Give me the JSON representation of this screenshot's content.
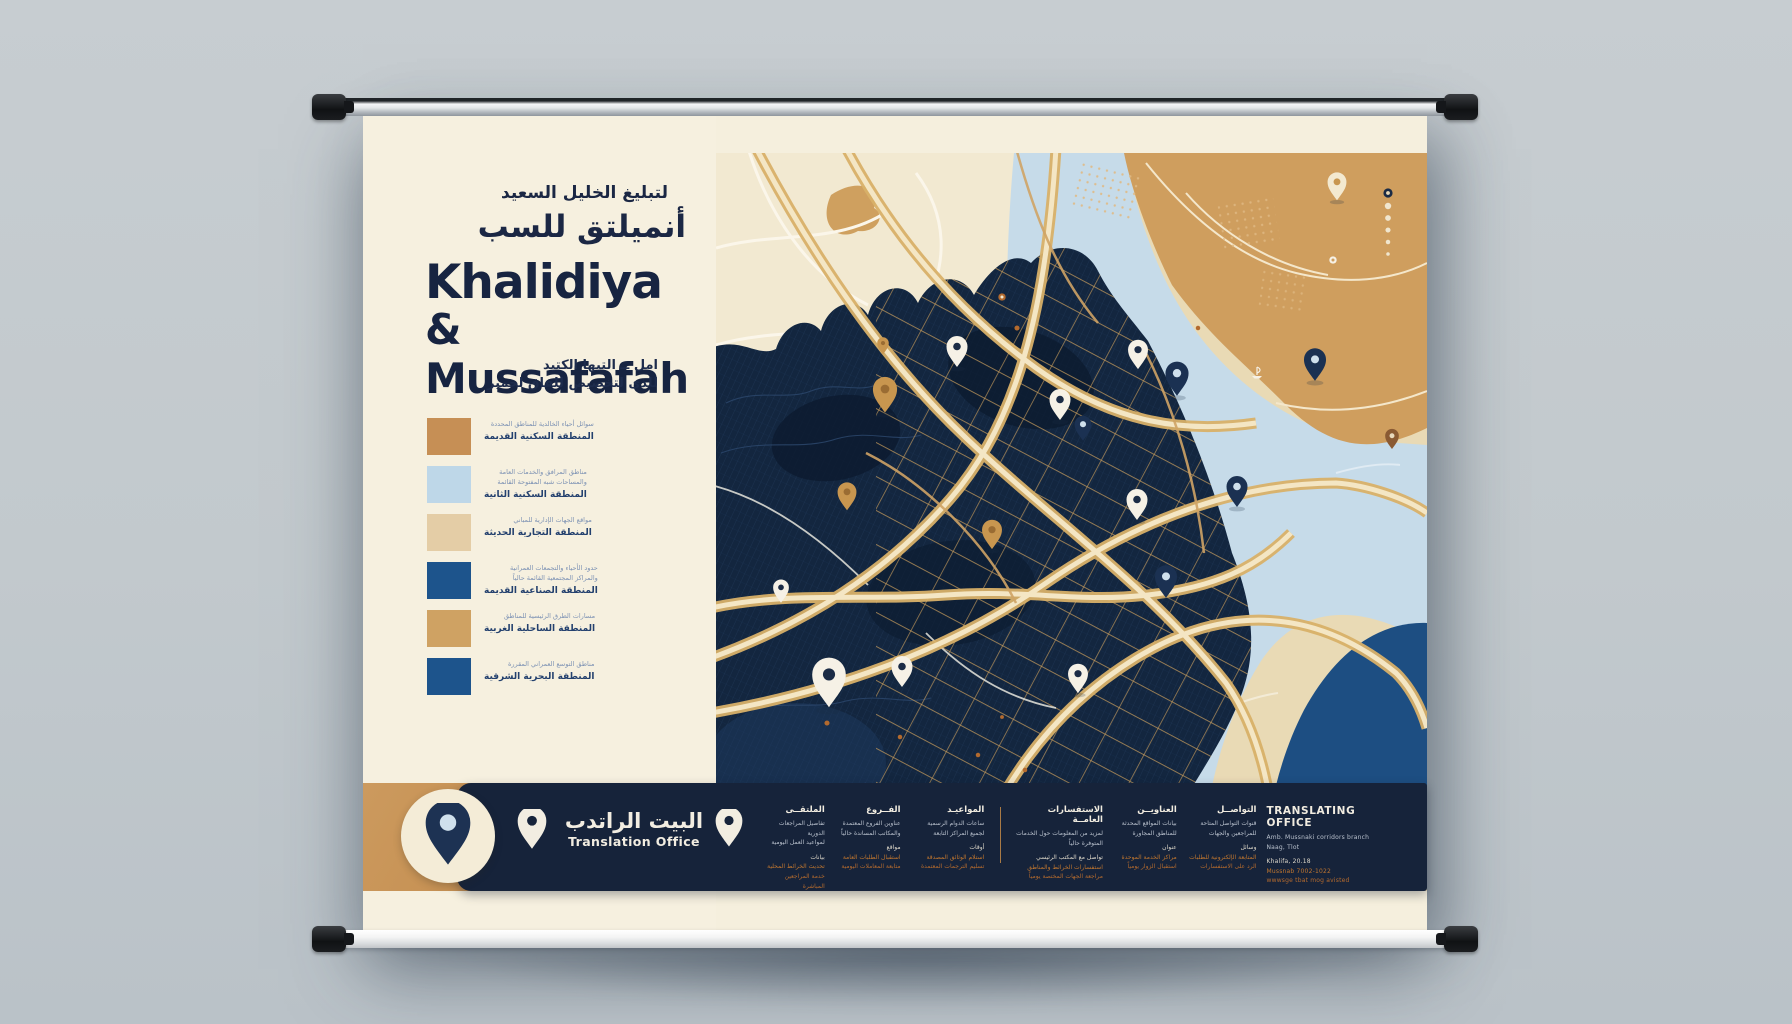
{
  "poster": {
    "title": {
      "ar_line1": "لتبليغ الخليل السعيد",
      "ar_line2": "أنميلتق للسب",
      "en_line1": "Khalidiya",
      "en_line2": "& Mussafafah",
      "sub_ar_line1": "امل ــ التيها الكتيد",
      "sub_ar_line2": "للذى لتخصيص للفاق لحمير"
    },
    "legend": {
      "items": [
        {
          "color": "#c68f55",
          "lines": [
            {
              "style": "small",
              "text": "سوائل أحياء الخالدية للمناطق المحددة"
            },
            {
              "style": "bold",
              "text": "المنطقة السكنية القديمة"
            }
          ]
        },
        {
          "color": "#bed7e8",
          "lines": [
            {
              "style": "small",
              "text": "مناطق المرافق والخدمات العامة"
            },
            {
              "style": "small",
              "text": "والمساحات شبه المفتوحة القائمة"
            },
            {
              "style": "bold",
              "text": "المنطقة السكنية الثانية"
            }
          ]
        },
        {
          "color": "#e4cda6",
          "lines": [
            {
              "style": "small",
              "text": "مواقع الجهات الإدارية للمباني"
            },
            {
              "style": "bold",
              "text": "المنطقة التجارية الحديثة"
            }
          ]
        },
        {
          "color": "#1d548c",
          "lines": [
            {
              "style": "small",
              "text": "حدود الأحياء والتجمعات العمرانية"
            },
            {
              "style": "small",
              "text": "والمراكز المجتمعية القائمة حالياً"
            },
            {
              "style": "bold",
              "text": "المنطقة الصناعية القديمة"
            }
          ]
        },
        {
          "color": "#cfa263",
          "lines": [
            {
              "style": "small",
              "text": "مسارات الطرق الرئيسية للمناطق"
            },
            {
              "style": "bold",
              "text": "المنطقة الساحلية الغربية"
            }
          ]
        },
        {
          "color": "#1d548c",
          "lines": [
            {
              "style": "small",
              "text": "مناطق التوسع العمراني المقررة"
            },
            {
              "style": "bold",
              "text": "المنطقة البحرية الشرقية"
            }
          ]
        }
      ]
    },
    "footer": {
      "brand": {
        "ar": "البيت الراتدب",
        "en": "Translation Office"
      },
      "columns": [
        {
          "header": "الملتقــى",
          "width": 62,
          "lines": [
            "تفاصيل المراجعات الدورية",
            "لمواعيد العمل اليومية",
            "بيانات",
            "تحديث الخرائط المحلية",
            "خدمة المراجعين المباشرة"
          ]
        },
        {
          "header": "الفــروع",
          "width": 66,
          "lines": [
            "عناوين الفروع المعتمدة",
            "والمكاتب المساندة حالياً",
            "مواقع",
            "استقبال الطلبات العامة",
            "متابعة المعاملات اليومية"
          ]
        },
        {
          "header": "المواعيـد",
          "width": 74,
          "lines": [
            "ساعات الدوام الرسمية",
            "لجميع المراكز التابعة",
            "أوقات",
            "استلام الوثائق المصدقة",
            "تسليم الترجمات المعتمدة"
          ]
        },
        {
          "header": "الاستفسارات العامــة",
          "width": 88,
          "divider_before": true,
          "lines": [
            "لمزيد من المعلومات حول الخدمات",
            "المتوفرة حالياً",
            "تواصل مع المكتب الرئيسي",
            "استفسارات الخرائط والمناطق",
            "مراجعة الجهات المختصة يومياً"
          ]
        },
        {
          "header": "العناويــن",
          "width": 64,
          "lines": [
            "بيانات المواقع المحدثة",
            "للمناطق المجاورة",
            "عنوان",
            "مراكز الخدمة الموحدة",
            "استقبال الزوار يومياً"
          ]
        },
        {
          "header": "التواصــل",
          "width": 70,
          "lines": [
            "قنوات التواصل المتاحة",
            "للمراجعين والجهات",
            "وسائل",
            "المتابعة الإلكترونية للطلبات",
            "الرد على الاستفسارات"
          ]
        },
        {
          "header": "TRANSLATING OFFICE",
          "width": 135,
          "latin": true,
          "lines": [
            "Amb. Mussnaki corridors branch",
            "Naag, Tlot",
            "Khalifa, 20.18",
            "Mussnab 7002-1022",
            "wwwsge tbat mog avisted"
          ]
        }
      ]
    },
    "map": {
      "colors": {
        "base": "#e9dab5",
        "light": "#f2e9d1",
        "tan_land": "#cf9e5e",
        "river": "#c6dbe9",
        "deep_water": "#1d4e82",
        "city": "#13263f",
        "city_dark": "#0d1b30",
        "road_gold": "#e6c48c",
        "road_core": "#f7ecd2",
        "white_road": "#faf4e6",
        "accent_orange": "#b36a2e"
      },
      "pin_colors": {
        "white": {
          "body": "#f6f1e6",
          "hole": "#1b2b45"
        },
        "navy": {
          "body": "#1b3152",
          "hole": "#cfe0ec"
        },
        "gold": {
          "body": "#c8964f",
          "hole": "#9a6c33"
        },
        "cream": {
          "body": "#f3e9d0",
          "hole": "#c8964f"
        },
        "brown": {
          "body": "#8a5a33",
          "hole": "#e8d9bd"
        },
        "dot-orange": {
          "body": "#b36a2e"
        },
        "dot-cream": {
          "body": "#f0e6cf"
        },
        "dot-white": {
          "body": "#f6f1e6"
        },
        "ring-navy": {
          "body": "#1b2b45",
          "hole": "#ead9b5"
        },
        "ring-white": {
          "body": "#f6f1e6",
          "hole": "#cf9e5e"
        },
        "ring-orange": {
          "body": "#b36a2e",
          "hole": "#f3e9d0"
        }
      },
      "pins": [
        {
          "x": 621,
          "y": 32,
          "kind": "cream",
          "s": 0.9
        },
        {
          "x": 672,
          "y": 40,
          "kind": "ring-navy",
          "s": 1
        },
        {
          "x": 672,
          "y": 53,
          "kind": "dot-cream",
          "s": 1
        },
        {
          "x": 672,
          "y": 65,
          "kind": "dot-cream",
          "s": 0.9
        },
        {
          "x": 672,
          "y": 77,
          "kind": "dot-cream",
          "s": 0.8
        },
        {
          "x": 672,
          "y": 89,
          "kind": "dot-cream",
          "s": 0.7
        },
        {
          "x": 672,
          "y": 101,
          "kind": "dot-cream",
          "s": 0.55
        },
        {
          "x": 617,
          "y": 107,
          "kind": "ring-white",
          "s": 0.8
        },
        {
          "x": 286,
          "y": 144,
          "kind": "ring-orange",
          "s": 0.8
        },
        {
          "x": 301,
          "y": 175,
          "kind": "dot-orange",
          "s": 0.8
        },
        {
          "x": 167,
          "y": 192,
          "kind": "gold",
          "s": 0.55
        },
        {
          "x": 241,
          "y": 197,
          "kind": "white",
          "s": 1
        },
        {
          "x": 422,
          "y": 200,
          "kind": "white",
          "s": 0.95
        },
        {
          "x": 599,
          "y": 210,
          "kind": "navy",
          "s": 1.05
        },
        {
          "x": 461,
          "y": 224,
          "kind": "navy",
          "s": 1.1
        },
        {
          "x": 169,
          "y": 240,
          "kind": "gold",
          "s": 1.15
        },
        {
          "x": 344,
          "y": 250,
          "kind": "white",
          "s": 1
        },
        {
          "x": 367,
          "y": 274,
          "kind": "navy",
          "s": 0.8
        },
        {
          "x": 676,
          "y": 285,
          "kind": "brown",
          "s": 0.65
        },
        {
          "x": 482,
          "y": 175,
          "kind": "dot-orange",
          "s": 0.7
        },
        {
          "x": 276,
          "y": 380,
          "kind": "gold",
          "s": 0.95
        },
        {
          "x": 131,
          "y": 342,
          "kind": "gold",
          "s": 0.9
        },
        {
          "x": 421,
          "y": 350,
          "kind": "white",
          "s": 1
        },
        {
          "x": 521,
          "y": 337,
          "kind": "navy",
          "s": 1
        },
        {
          "x": 450,
          "y": 427,
          "kind": "navy",
          "s": 1.05
        },
        {
          "x": 65,
          "y": 437,
          "kind": "white",
          "s": 0.75
        },
        {
          "x": 113,
          "y": 527,
          "kind": "white",
          "s": 1.6
        },
        {
          "x": 186,
          "y": 517,
          "kind": "white",
          "s": 1
        },
        {
          "x": 362,
          "y": 524,
          "kind": "white",
          "s": 0.95
        },
        {
          "x": 111,
          "y": 570,
          "kind": "dot-orange",
          "s": 0.8
        },
        {
          "x": 184,
          "y": 584,
          "kind": "dot-orange",
          "s": 0.7
        },
        {
          "x": 262,
          "y": 602,
          "kind": "dot-orange",
          "s": 0.7
        },
        {
          "x": 286,
          "y": 564,
          "kind": "dot-orange",
          "s": 0.6
        },
        {
          "x": 309,
          "y": 617,
          "kind": "dot-orange",
          "s": 0.7
        }
      ]
    }
  }
}
